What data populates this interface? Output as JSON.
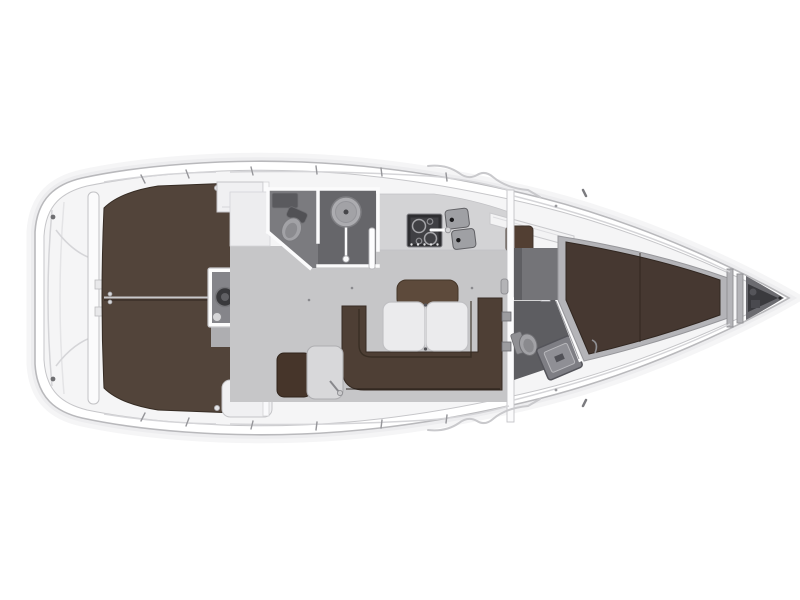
{
  "diagram": {
    "title": "Sailing yacht interior layout plan (top view)",
    "view": "overhead floor plan",
    "components": [
      "stern swim platform",
      "transom locker",
      "aft port cabin double berth",
      "aft starboard cabin double berth",
      "engine compartment",
      "companionway steps",
      "salon floor",
      "U-shaped settee",
      "folding salon table (two leaves)",
      "navigation seat",
      "chart table",
      "aft head with toilet and shower",
      "galley with two-burner stove and double sink",
      "forward head with toilet and shower tray",
      "forward V-berth cabin",
      "anchor locker with windlass",
      "side decks"
    ]
  },
  "colors": {
    "page_bg": "#ffffff",
    "hull_fill": "#ffffff",
    "hull_stroke": "#b9b9bc",
    "hull_shadow": "#ededef",
    "hull_shadow_soft": "#f5f5f6",
    "deck_fill": "#f5f5f6",
    "deck_line": "#d5d5d8",
    "wall_white": "#fbfbfc",
    "locker_white": "#f0f0f2",
    "cabinet_white": "#ededef",
    "step_white": "#e8e8ea",
    "floor_gray": "#c6c6c8",
    "galley_gray": "#d3d3d5",
    "strip_gray": "#aeaeb1",
    "berth_brown": "#52443a",
    "fwd_berth_brown": "#463831",
    "sofa_brown": "#4e3f35",
    "backrest_brown": "#5d4a3b",
    "seat_brown": "#46352a",
    "counter_block_brown": "#523f33",
    "table_white": "#ebebed",
    "nav_table_gray": "#d8d8da",
    "engine_frame": "#85858a",
    "engine_dark": "#2b2b2e",
    "stove_dark": "#2d2d30",
    "sink_gray": "#9fa0a4",
    "head1_floor": "#7b7b7f",
    "head1_shower_floor": "#66666a",
    "head2_floor": "#5d5d61",
    "fixture_gray": "#a2a2a6",
    "fixture_dark": "#515155",
    "tray_gray": "#7e7e84",
    "molding_gray": "#b4b4b8",
    "entry_floor": "#747478",
    "anchor_floor": "#6b6b70",
    "windlass_dark": "#3a3a3e",
    "metal_gray": "#9c9c9f",
    "rod_light": "#c9c9cb"
  }
}
